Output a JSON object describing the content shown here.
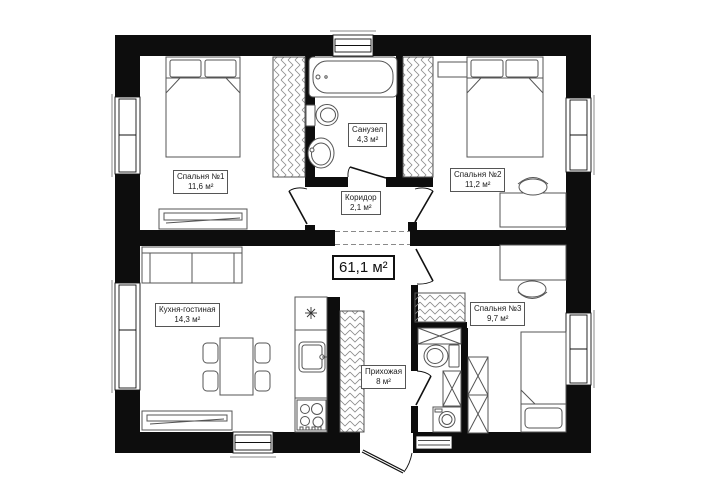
{
  "plan": {
    "type": "apartment-floor-plan",
    "total_area": "61,1 м²",
    "rooms": [
      {
        "name": "Спальня №1",
        "area": "11,6 м²"
      },
      {
        "name": "Санузел",
        "area": "4,3 м²"
      },
      {
        "name": "Спальня №2",
        "area": "11,2 м²"
      },
      {
        "name": "Коридор",
        "area": "2,1 м²"
      },
      {
        "name": "Кухня-гостиная",
        "area": "14,3 м²"
      },
      {
        "name": "Прихожая",
        "area": "8 м²"
      },
      {
        "name": "Спальня №3",
        "area": "9,7 м²"
      }
    ],
    "colors": {
      "wall": "#0d0d0d",
      "furniture_line": "#555555",
      "hatch": "#8a8a8a"
    }
  }
}
